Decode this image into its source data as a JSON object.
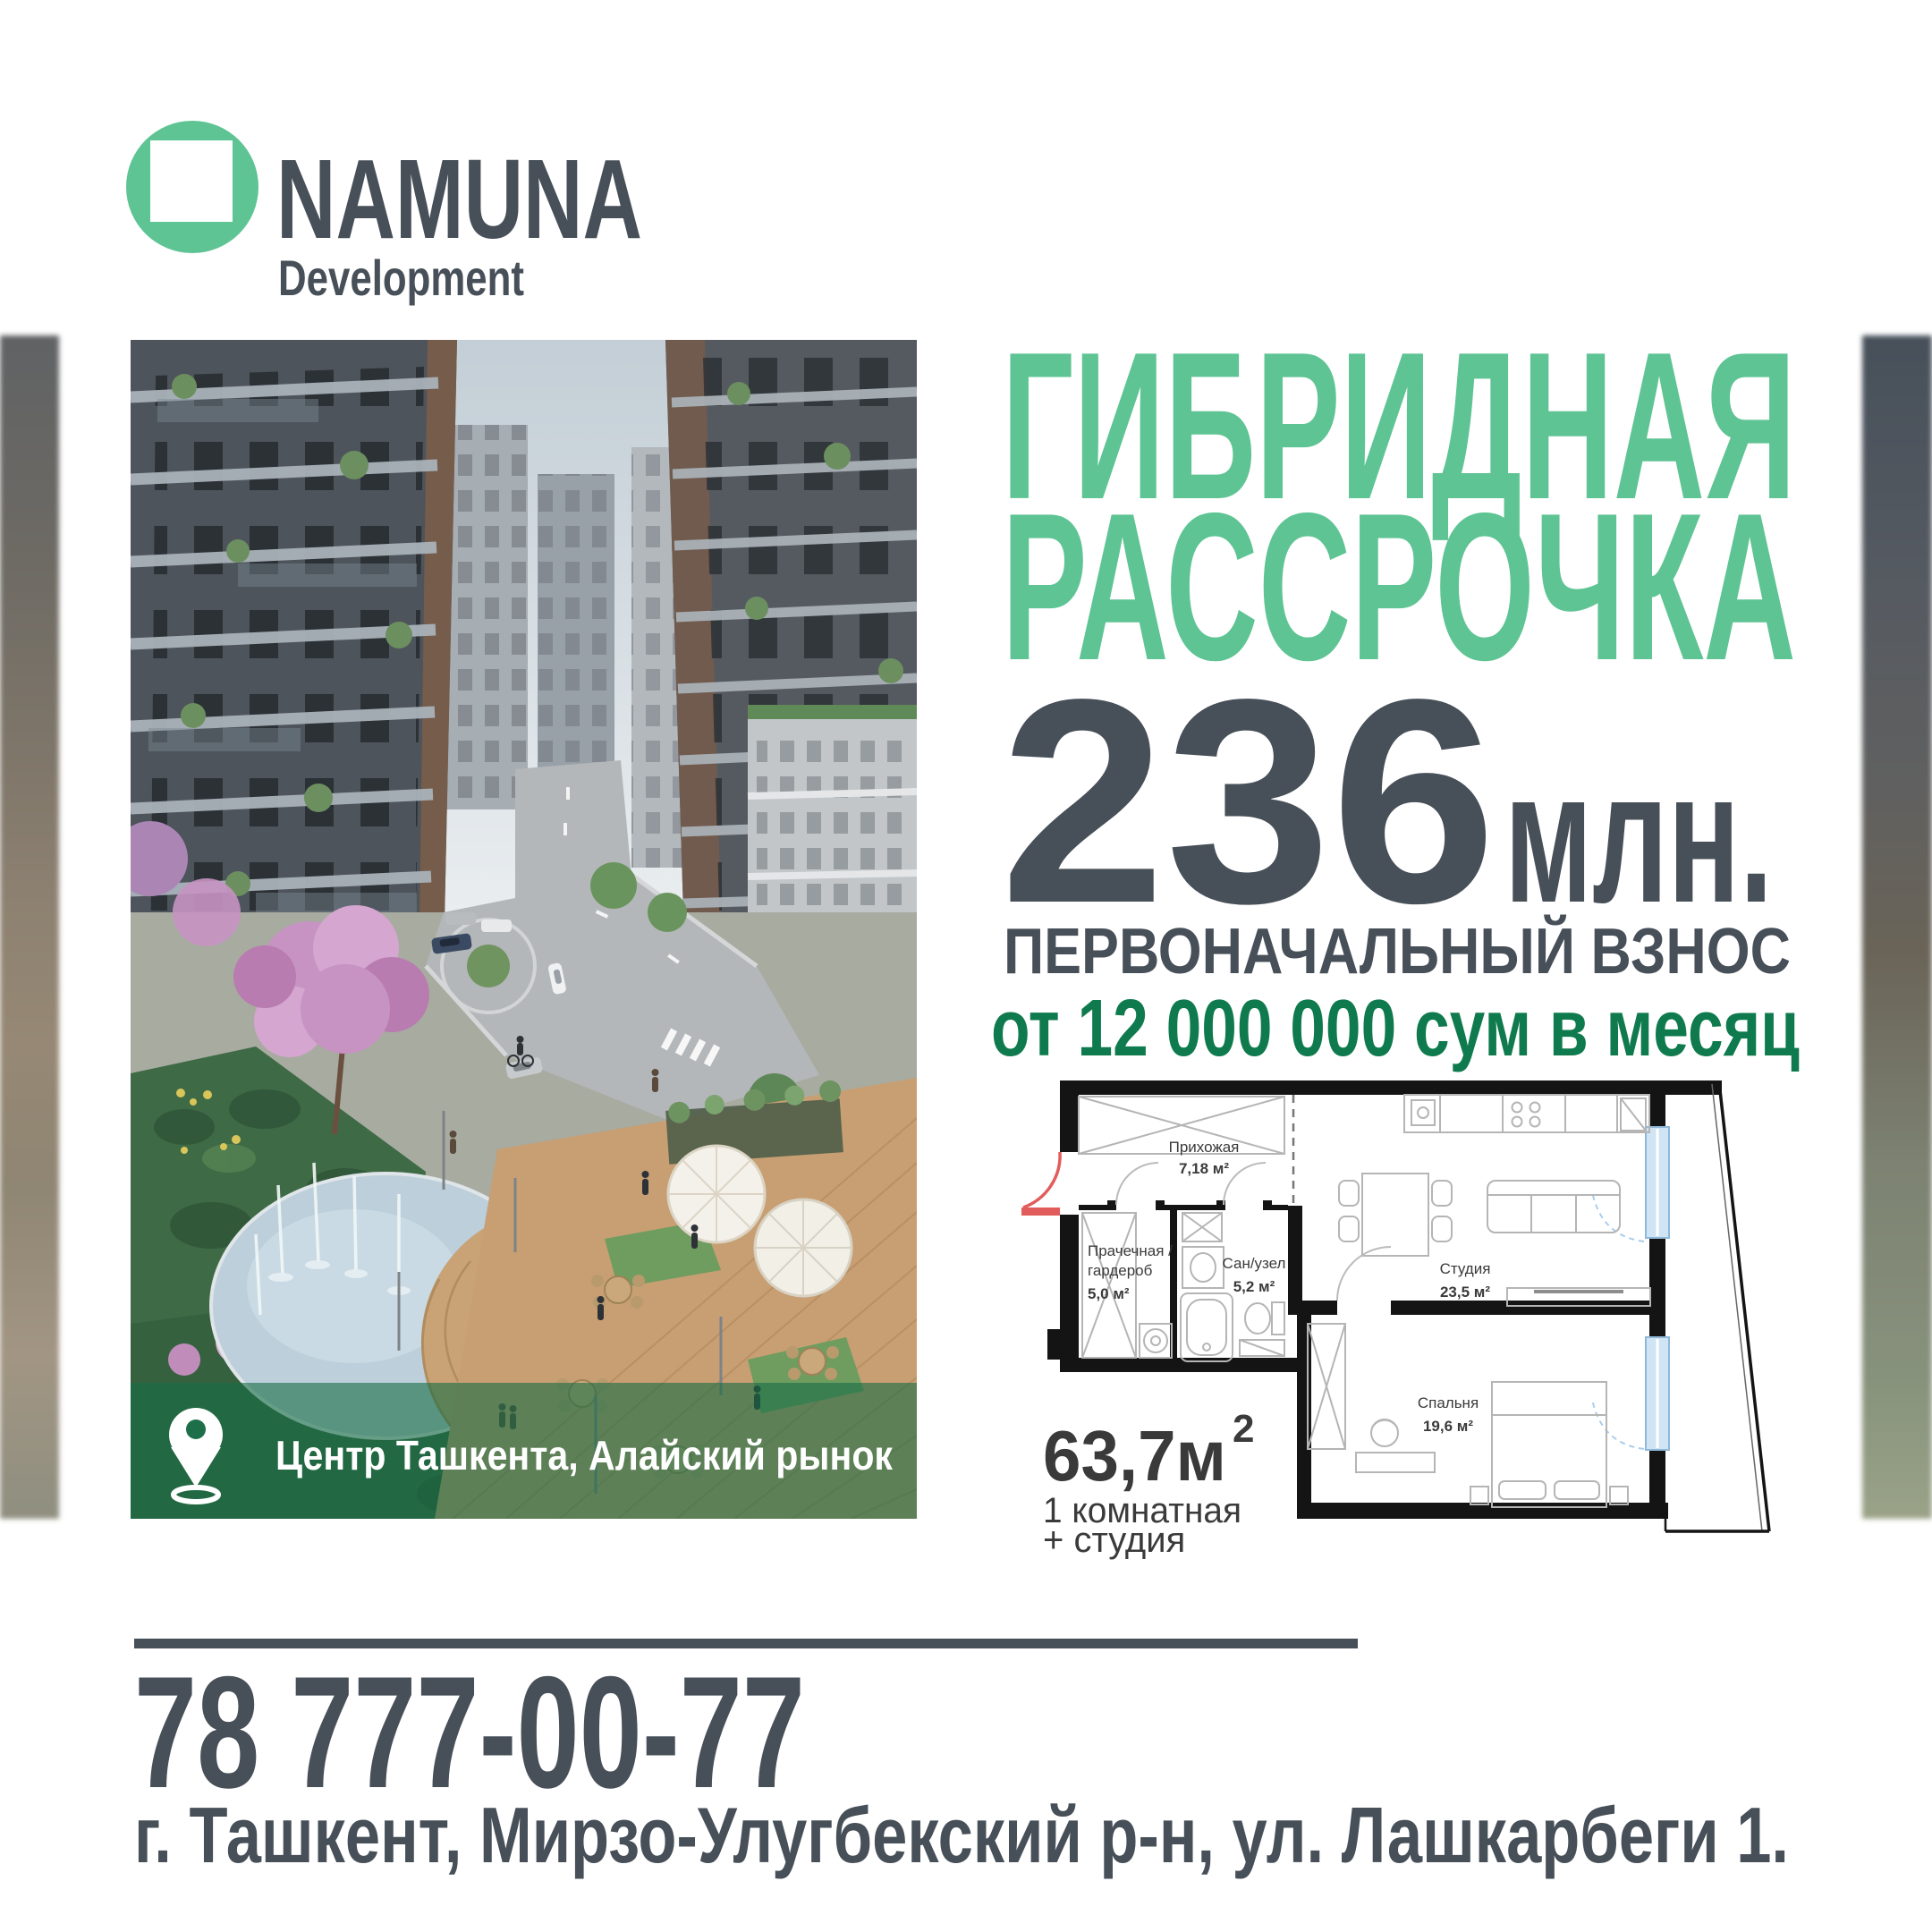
{
  "logo": {
    "brand": "NAMUNA",
    "subtitle": "Development"
  },
  "headline": {
    "line1": "ГИБРИДНАЯ",
    "line2": "РАССРОЧКА"
  },
  "offer": {
    "amount": "236",
    "unit": "млн.",
    "down_payment_label": "ПЕРВОНАЧАЛЬНЫЙ ВЗНОС",
    "monthly": "от 12 000 000 сум в месяц"
  },
  "location": {
    "badge": "Центр Ташкента, Алайский рынок"
  },
  "plan": {
    "hall": {
      "name": "Прихожая",
      "area": "7,18 м²"
    },
    "laundry": {
      "name_line1": "Прачечная /",
      "name_line2": "гардероб",
      "area": "5,0 м²"
    },
    "bath": {
      "name": "Сан/узел",
      "area": "5,2 м²"
    },
    "studio": {
      "name": "Студия",
      "area": "23,5 м²"
    },
    "bedroom": {
      "name": "Спальня",
      "area": "19,6 м²"
    },
    "total": {
      "value": "63,7м",
      "sup": "2",
      "line1": "1 комнатная",
      "line2": "+ студия"
    }
  },
  "contact": {
    "phone": "78 777-00-77",
    "address": "г. Ташкент, Мирзо-Улугбекский р-н, ул. Лашкарбеги 1."
  },
  "colors": {
    "green": "#5ec493",
    "green_dark": "#0e7a4d",
    "slate": "#474f58",
    "plan_text": "#3a3a3a",
    "overlay_green": "#156c45",
    "door_red": "#e25c5c",
    "window_blue": "#cfe4f4"
  }
}
